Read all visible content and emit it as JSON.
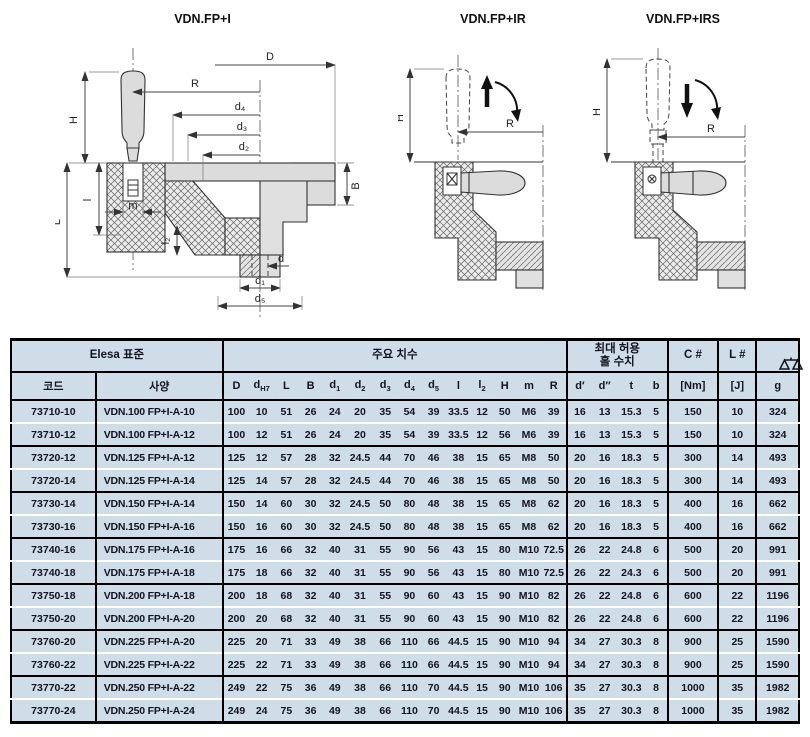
{
  "drawings": {
    "fp_i": {
      "title": "VDN.FP+I",
      "labels": {
        "D": "D",
        "R": "R",
        "d4": "d₄",
        "d3": "d₃",
        "d2": "d₂",
        "H": "H",
        "L": "L",
        "l": "l",
        "m": "m",
        "l2": "l₂",
        "B": "B",
        "d": "d",
        "d1": "d₁",
        "d5": "d₅"
      }
    },
    "fp_ir": {
      "title": "VDN.FP+IR",
      "labels": {
        "H": "H",
        "R": "R"
      }
    },
    "fp_irs": {
      "title": "VDN.FP+IRS",
      "labels": {
        "H": "H",
        "R": "R"
      }
    }
  },
  "table": {
    "colors": {
      "row_bg": "#cedde8",
      "border": "#000000",
      "text": "#141420"
    },
    "header_groups": [
      {
        "name": "header-elesa-standard",
        "label": "Elesa 표준",
        "span": 2
      },
      {
        "name": "header-main-dimensions",
        "label": "주요 치수",
        "span": 14
      },
      {
        "name": "header-max-hole",
        "lines": [
          "최대 허용",
          "홀 수치"
        ],
        "span": 4
      },
      {
        "name": "header-c",
        "label": "C #",
        "span": 1
      },
      {
        "name": "header-l",
        "label": "L #",
        "span": 1
      },
      {
        "name": "header-weight",
        "icon": "scale-icon",
        "span": 1
      }
    ],
    "columns": [
      {
        "key": "code",
        "base": "코드"
      },
      {
        "key": "spec",
        "base": "사양"
      },
      {
        "key": "D",
        "base": "D"
      },
      {
        "key": "dH7",
        "base": "d",
        "sub": "H7"
      },
      {
        "key": "L",
        "base": "L"
      },
      {
        "key": "B",
        "base": "B"
      },
      {
        "key": "d1",
        "base": "d",
        "sub": "1"
      },
      {
        "key": "d2",
        "base": "d",
        "sub": "2"
      },
      {
        "key": "d3",
        "base": "d",
        "sub": "3"
      },
      {
        "key": "d4",
        "base": "d",
        "sub": "4"
      },
      {
        "key": "d5",
        "base": "d",
        "sub": "5"
      },
      {
        "key": "l",
        "base": "l"
      },
      {
        "key": "l2",
        "base": "l",
        "sub": "2"
      },
      {
        "key": "H",
        "base": "H"
      },
      {
        "key": "m",
        "base": "m"
      },
      {
        "key": "R",
        "base": "R"
      },
      {
        "key": "d-prime",
        "base": "d′"
      },
      {
        "key": "d-dprime",
        "base": "d″"
      },
      {
        "key": "t",
        "base": "t"
      },
      {
        "key": "b",
        "base": "b"
      },
      {
        "key": "Nm",
        "base": "[Nm]"
      },
      {
        "key": "J",
        "base": "[J]"
      },
      {
        "key": "g",
        "base": "g"
      }
    ],
    "rows": [
      {
        "code": "73710-10",
        "spec": "VDN.100 FP+I-A-10",
        "values": [
          "100",
          "10",
          "51",
          "26",
          "24",
          "20",
          "35",
          "54",
          "39",
          "33.5",
          "12",
          "50",
          "M6",
          "39",
          "16",
          "13",
          "15.3",
          "5",
          "150",
          "10",
          "324"
        ]
      },
      {
        "code": "73710-12",
        "spec": "VDN.100 FP+I-A-12",
        "values": [
          "100",
          "12",
          "51",
          "26",
          "24",
          "20",
          "35",
          "54",
          "39",
          "33.5",
          "12",
          "56",
          "M6",
          "39",
          "16",
          "13",
          "15.3",
          "5",
          "150",
          "10",
          "324"
        ]
      },
      {
        "code": "73720-12",
        "spec": "VDN.125 FP+I-A-12",
        "values": [
          "125",
          "12",
          "57",
          "28",
          "32",
          "24.5",
          "44",
          "70",
          "46",
          "38",
          "15",
          "65",
          "M8",
          "50",
          "20",
          "16",
          "18.3",
          "5",
          "300",
          "14",
          "493"
        ]
      },
      {
        "code": "73720-14",
        "spec": "VDN.125 FP+I-A-14",
        "values": [
          "125",
          "14",
          "57",
          "28",
          "32",
          "24.5",
          "44",
          "70",
          "46",
          "38",
          "15",
          "65",
          "M8",
          "50",
          "20",
          "16",
          "18.3",
          "5",
          "300",
          "14",
          "493"
        ]
      },
      {
        "code": "73730-14",
        "spec": "VDN.150 FP+I-A-14",
        "values": [
          "150",
          "14",
          "60",
          "30",
          "32",
          "24.5",
          "50",
          "80",
          "48",
          "38",
          "15",
          "65",
          "M8",
          "62",
          "20",
          "16",
          "18.3",
          "5",
          "400",
          "16",
          "662"
        ]
      },
      {
        "code": "73730-16",
        "spec": "VDN.150 FP+I-A-16",
        "values": [
          "150",
          "16",
          "60",
          "30",
          "32",
          "24.5",
          "50",
          "80",
          "48",
          "38",
          "15",
          "65",
          "M8",
          "62",
          "20",
          "16",
          "18.3",
          "5",
          "400",
          "16",
          "662"
        ]
      },
      {
        "code": "73740-16",
        "spec": "VDN.175 FP+I-A-16",
        "values": [
          "175",
          "16",
          "66",
          "32",
          "40",
          "31",
          "55",
          "90",
          "56",
          "43",
          "15",
          "80",
          "M10",
          "72.5",
          "26",
          "22",
          "24.8",
          "6",
          "500",
          "20",
          "991"
        ]
      },
      {
        "code": "73740-18",
        "spec": "VDN.175 FP+I-A-18",
        "values": [
          "175",
          "18",
          "66",
          "32",
          "40",
          "31",
          "55",
          "90",
          "56",
          "43",
          "15",
          "80",
          "M10",
          "72.5",
          "26",
          "22",
          "24.3",
          "6",
          "500",
          "20",
          "991"
        ]
      },
      {
        "code": "73750-18",
        "spec": "VDN.200 FP+I-A-18",
        "values": [
          "200",
          "18",
          "68",
          "32",
          "40",
          "31",
          "55",
          "90",
          "60",
          "43",
          "15",
          "90",
          "M10",
          "82",
          "26",
          "22",
          "24.8",
          "6",
          "600",
          "22",
          "1196"
        ]
      },
      {
        "code": "73750-20",
        "spec": "VDN.200 FP+I-A-20",
        "values": [
          "200",
          "20",
          "68",
          "32",
          "40",
          "31",
          "55",
          "90",
          "60",
          "43",
          "15",
          "90",
          "M10",
          "82",
          "26",
          "22",
          "24.8",
          "6",
          "600",
          "22",
          "1196"
        ]
      },
      {
        "code": "73760-20",
        "spec": "VDN.225 FP+I-A-20",
        "values": [
          "225",
          "20",
          "71",
          "33",
          "49",
          "38",
          "66",
          "110",
          "66",
          "44.5",
          "15",
          "90",
          "M10",
          "94",
          "34",
          "27",
          "30.3",
          "8",
          "900",
          "25",
          "1590"
        ]
      },
      {
        "code": "73760-22",
        "spec": "VDN.225 FP+I-A-22",
        "values": [
          "225",
          "22",
          "71",
          "33",
          "49",
          "38",
          "66",
          "110",
          "66",
          "44.5",
          "15",
          "90",
          "M10",
          "94",
          "34",
          "27",
          "30.3",
          "8",
          "900",
          "25",
          "1590"
        ]
      },
      {
        "code": "73770-22",
        "spec": "VDN.250 FP+I-A-22",
        "values": [
          "249",
          "22",
          "75",
          "36",
          "49",
          "38",
          "66",
          "110",
          "70",
          "44.5",
          "15",
          "90",
          "M10",
          "106",
          "35",
          "27",
          "30.3",
          "8",
          "1000",
          "35",
          "1982"
        ]
      },
      {
        "code": "73770-24",
        "spec": "VDN.250 FP+I-A-24",
        "values": [
          "249",
          "24",
          "75",
          "36",
          "49",
          "38",
          "66",
          "110",
          "70",
          "44.5",
          "15",
          "90",
          "M10",
          "106",
          "35",
          "27",
          "30.3",
          "8",
          "1000",
          "35",
          "1982"
        ]
      }
    ]
  }
}
